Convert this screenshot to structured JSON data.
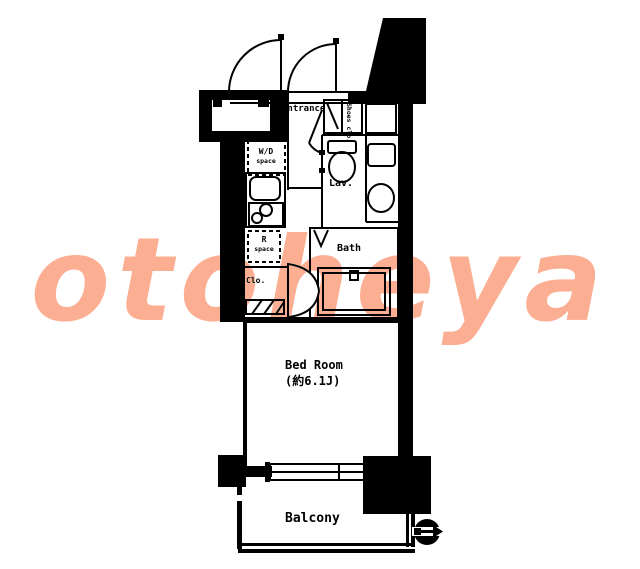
{
  "watermark": {
    "text": "otoheya",
    "color": "#fbae92"
  },
  "colors": {
    "line": "#000000",
    "background": "#ffffff"
  },
  "floorplan": {
    "labels": {
      "entrance": "Entrance",
      "shoes_closet": "Shoes clo.",
      "lavatory": "Lav.",
      "bath": "Bath",
      "washer_dryer_top": "W/D",
      "washer_dryer_sub": "space",
      "refrigerator_top": "R",
      "refrigerator_sub": "space",
      "closet": "Clo.",
      "bedroom_name": "Bed Room",
      "bedroom_size": "(約6.1J)",
      "balcony": "Balcony"
    }
  }
}
